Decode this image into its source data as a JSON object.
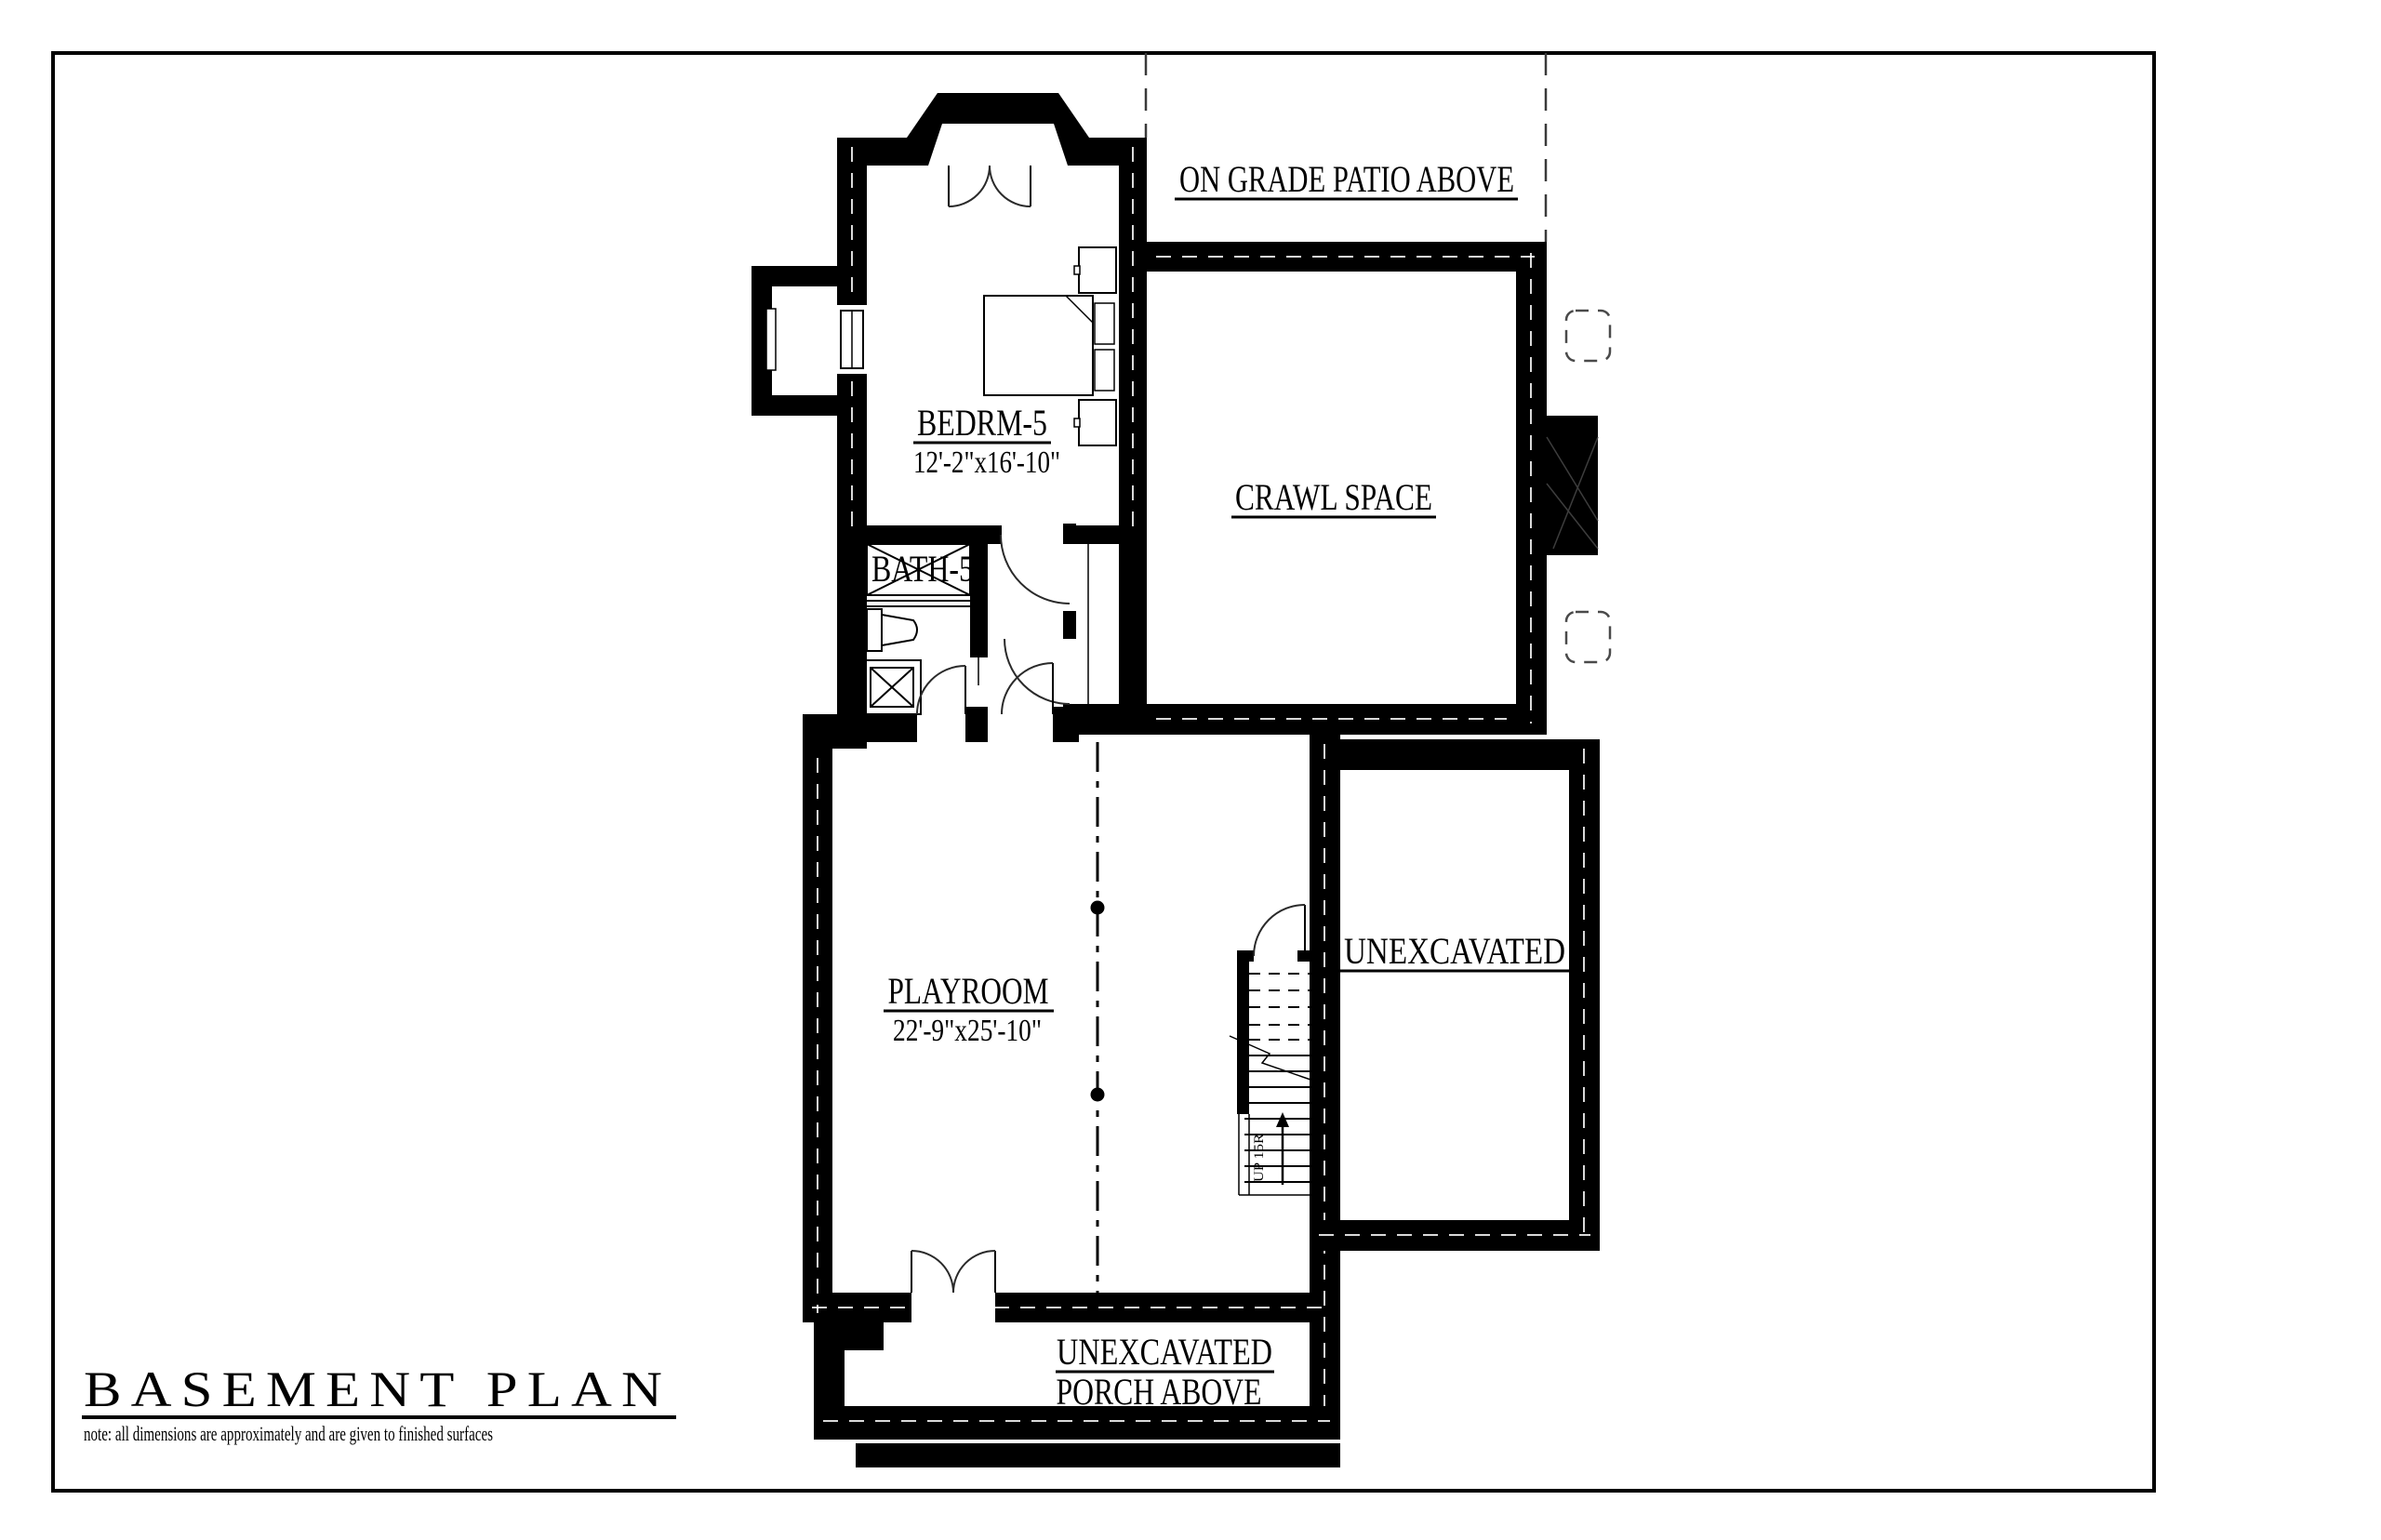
{
  "document": {
    "title": "BASEMENT PLAN",
    "note": "note: all dimensions are approximately and are given to finished surfaces"
  },
  "rooms": {
    "patio": {
      "label": "ON GRADE PATIO ABOVE"
    },
    "bedroom": {
      "name": "BEDRM-5",
      "dims": "12'-2\"x16'-10\""
    },
    "bath": {
      "name": "BATH-5"
    },
    "crawl": {
      "name": "CRAWL SPACE"
    },
    "playroom": {
      "name": "PLAYROOM",
      "dims": "22'-9\"x25'-10\""
    },
    "unexcavated": {
      "name": "UNEXCAVATED"
    },
    "porch": {
      "line1": "UNEXCAVATED",
      "line2": "PORCH ABOVE"
    }
  },
  "stairs": {
    "up_label": "UP 15R"
  },
  "colors": {
    "ink": "#000000",
    "paper": "#ffffff"
  }
}
